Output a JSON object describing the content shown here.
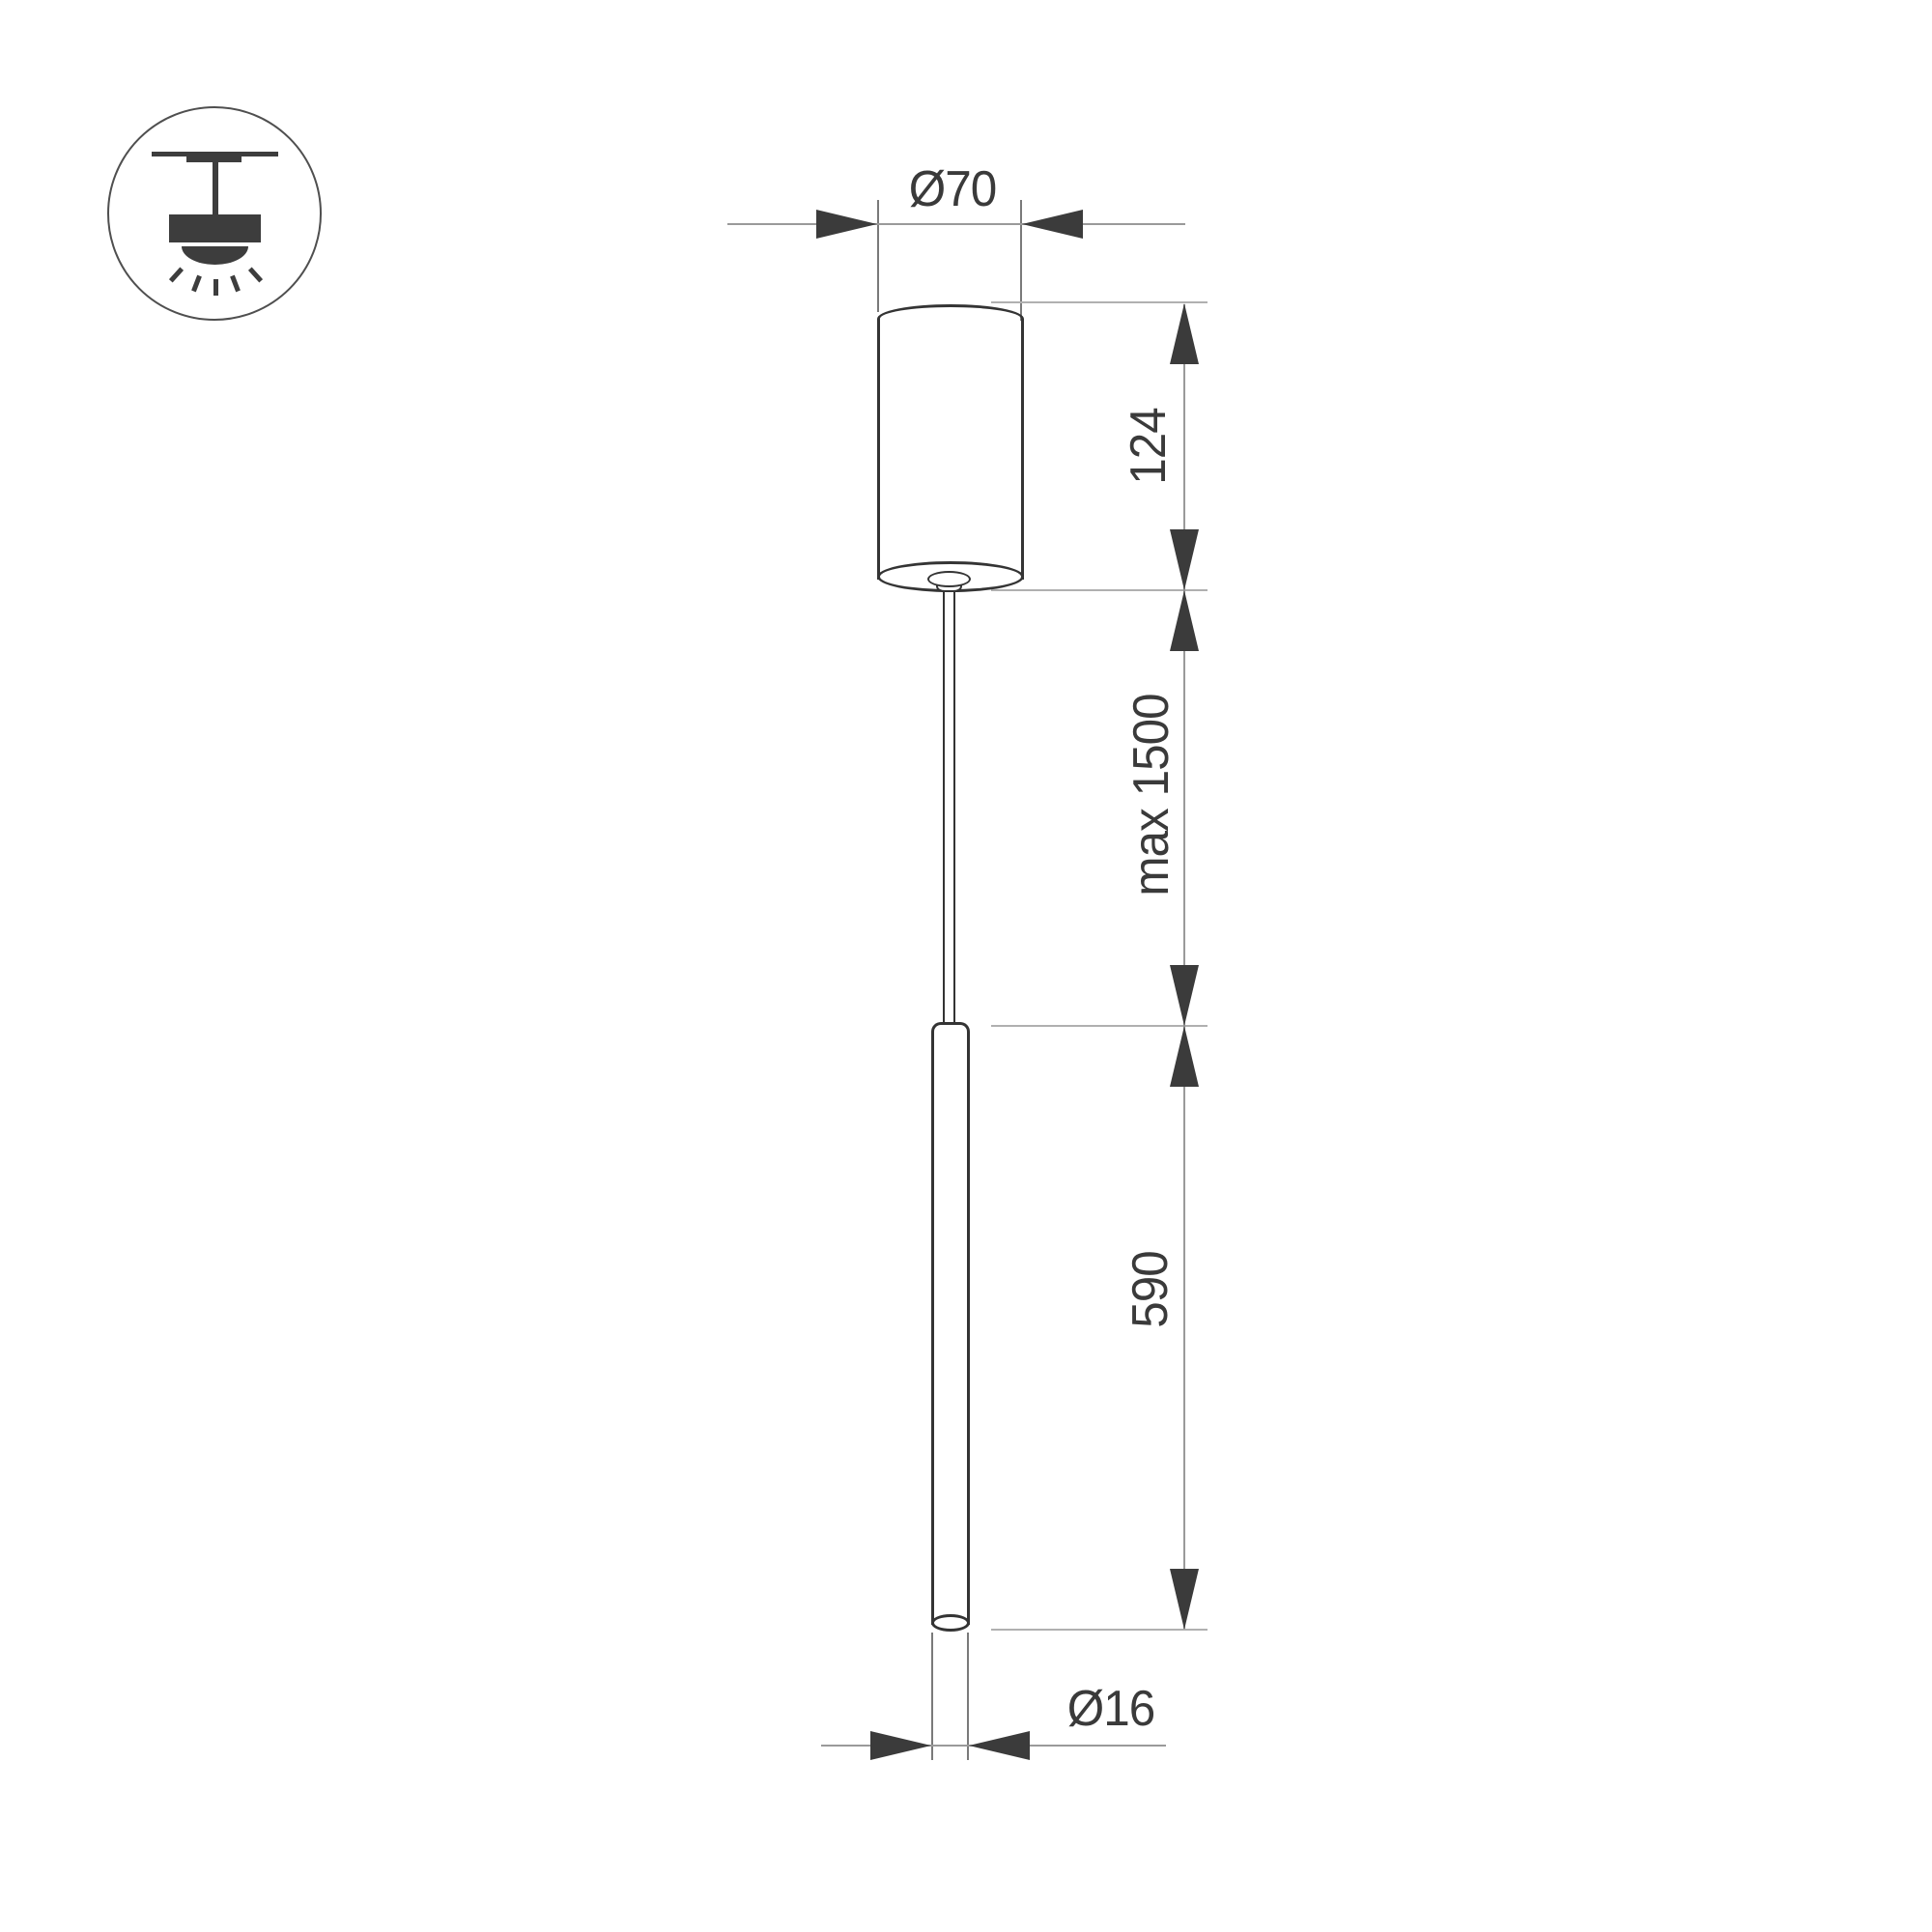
{
  "labels": {
    "canopy_diameter": "Ø70",
    "canopy_height": "124",
    "suspension_max": "max 1500",
    "tube_length": "590",
    "tube_diameter": "Ø16"
  },
  "colors": {
    "outline": "#343434",
    "dimline": "#9a9a9a",
    "extline": "#b0b0b0",
    "extline-dark": "#7a7a7a",
    "arrow": "#3b3b3b",
    "ink": "#3a3a3a",
    "icon": "#3d3d3d",
    "icon-circle": "#4f4f4f",
    "bg": "#ffffff"
  }
}
